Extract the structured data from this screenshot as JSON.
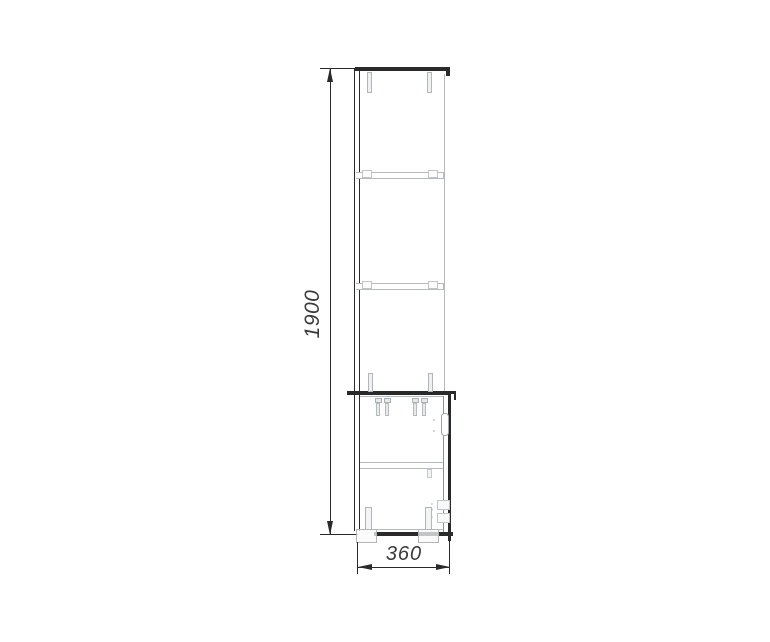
{
  "page": {
    "background": "#ffffff"
  },
  "drawing": {
    "description": "Side elevation technical drawing of a tall cabinet: open shelf section above, door unit with adjustable feet below",
    "dimensions": {
      "height": {
        "label": "1900"
      },
      "depth": {
        "label": "360"
      }
    },
    "colors": {
      "dark": "#2a2a2a",
      "light": "#b7babd",
      "mid": "#8d9296",
      "txt": "#3b3b3b",
      "bg": "#ffffff"
    }
  }
}
